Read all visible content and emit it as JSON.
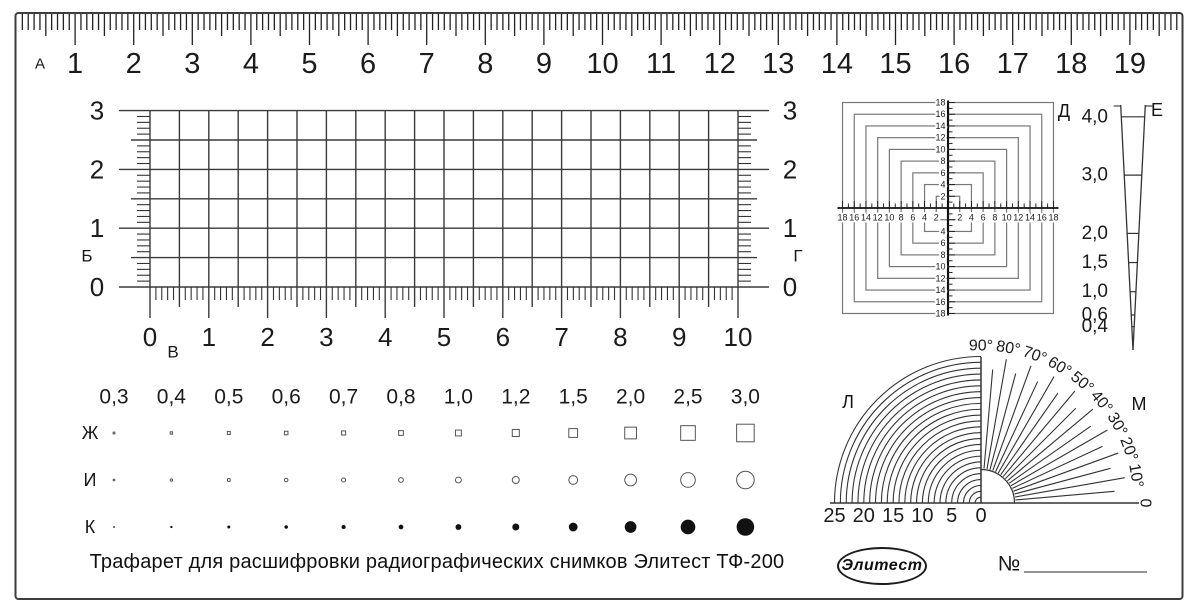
{
  "title_caption": "Трафарет для расшифровки радиографических снимков Элитест ТФ-200",
  "brand": {
    "logo_text": "Элитест",
    "serial_number_label": "№"
  },
  "ruler": {
    "section_letter": "А",
    "cm_labels": [
      "1",
      "2",
      "3",
      "4",
      "5",
      "6",
      "7",
      "8",
      "9",
      "10",
      "11",
      "12",
      "13",
      "14",
      "15",
      "16",
      "17",
      "18",
      "19"
    ]
  },
  "grid": {
    "left_letter": "Б",
    "bottom_letter": "В",
    "right_letter": "Г",
    "row_labels": [
      "3",
      "2",
      "1",
      "0"
    ],
    "col_labels": [
      "0",
      "1",
      "2",
      "3",
      "4",
      "5",
      "6",
      "7",
      "8",
      "9",
      "10"
    ],
    "minor_step": 0.5
  },
  "target": {
    "letter": "Д",
    "axis_labels": [
      "2",
      "4",
      "6",
      "8",
      "10",
      "12",
      "14",
      "16",
      "18"
    ],
    "tick_step_mm": 1
  },
  "wedge": {
    "letter": "Е",
    "thickness_labels": [
      "4,0",
      "3,0",
      "2,0",
      "1,5",
      "1,0",
      "0,6",
      "0,4"
    ]
  },
  "size_rows": {
    "headers": [
      "0,3",
      "0,4",
      "0,5",
      "0,6",
      "0,7",
      "0,8",
      "1,0",
      "1,2",
      "1,5",
      "2,0",
      "2,5",
      "3,0"
    ],
    "square_row_letter": "Ж",
    "circle_row_letter": "И",
    "dot_row_letter": "К"
  },
  "protractor": {
    "left_letter": "Л",
    "right_letter": "М",
    "arc_count": 25,
    "fan_step_deg": 5,
    "radius_labels": [
      "25",
      "20",
      "15",
      "10",
      "5",
      "0"
    ],
    "angle_labels": [
      "90°",
      "80°",
      "70°",
      "60°",
      "50°",
      "40°",
      "30°",
      "20°",
      "10°",
      "0"
    ]
  }
}
